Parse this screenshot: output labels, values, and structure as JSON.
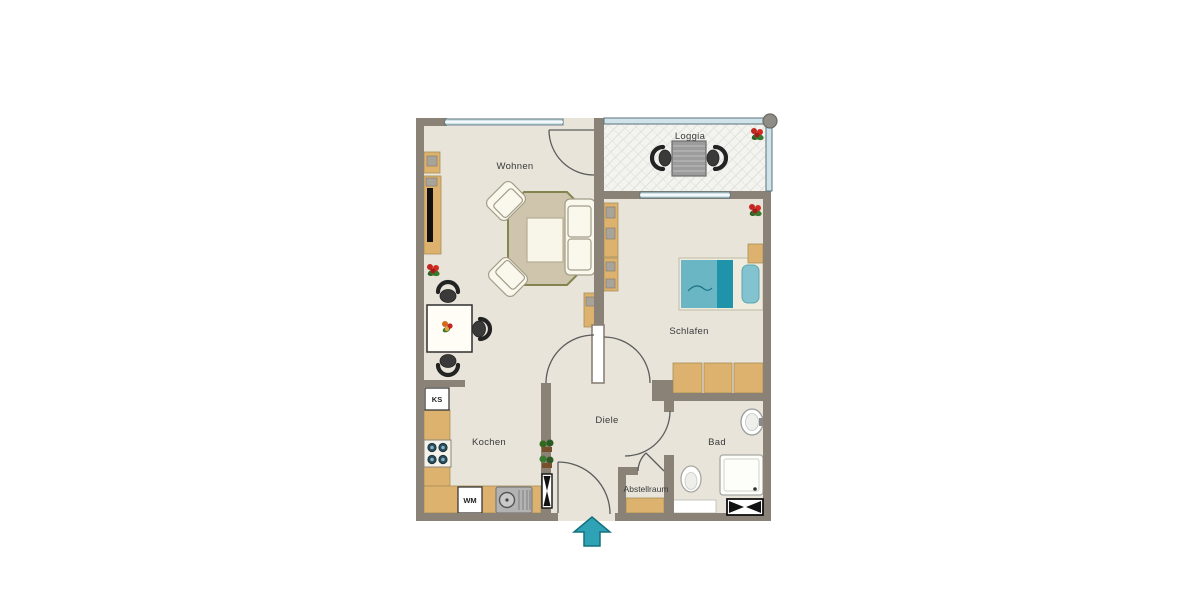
{
  "image": {
    "type": "apartment-floor-plan",
    "width": 1200,
    "height": 600
  },
  "rooms": {
    "wohnen": {
      "label": "Wohnen"
    },
    "loggia": {
      "label": "Loggia"
    },
    "schlafen": {
      "label": "Schlafen"
    },
    "diele": {
      "label": "Diele"
    },
    "kochen": {
      "label": "Kochen"
    },
    "bad": {
      "label": "Bad"
    },
    "abstellraum": {
      "label": "Abstellraum"
    }
  },
  "appliances": {
    "fridge": {
      "label": "KS"
    },
    "washer": {
      "label": "WM"
    }
  },
  "symbols": {
    "entrance_arrow": "entrance-direction-arrow",
    "vent_vertical": "vent-shaft-symbol",
    "vent_horizontal": "vent-shaft-symbol",
    "column": "corner-column"
  },
  "palette": {
    "wall": "#8a8177",
    "floor": "#e8e4da",
    "loggiaFloor": "#f3f3ef",
    "hatchLine": "#d8d8d2",
    "furniture": "#dcb26e",
    "furnitureEdge": "#a98e57",
    "rug": "#cfc5ad",
    "rugBorder": "#83844f",
    "upholstery": "#faf7ec",
    "upholsteryEdge": "#a39d88",
    "tableWhite": "#fffdf6",
    "bedTeal": "#6ab6c4",
    "bedTealDark": "#1f93a9",
    "pillow": "#82c3cf",
    "bedFrame": "#f0ecdd",
    "glass": "#cfe3ea",
    "glassFrame": "#5e7278",
    "chairDark": "#3a3a3a",
    "chairDarker": "#232323",
    "metal": "#b3b3b3",
    "metalEdge": "#7c7c7c",
    "arrow": "#2fa2b5",
    "arrowDark": "#15717f",
    "flowerRed": "#c22620",
    "flowerOrange": "#d2691e",
    "leafGreen": "#33691f",
    "potBrown": "#77502e",
    "doorLine": "#5c5c5c",
    "text": "#3a3a3a",
    "white": "#ffffff",
    "column": "#8f8d85"
  }
}
